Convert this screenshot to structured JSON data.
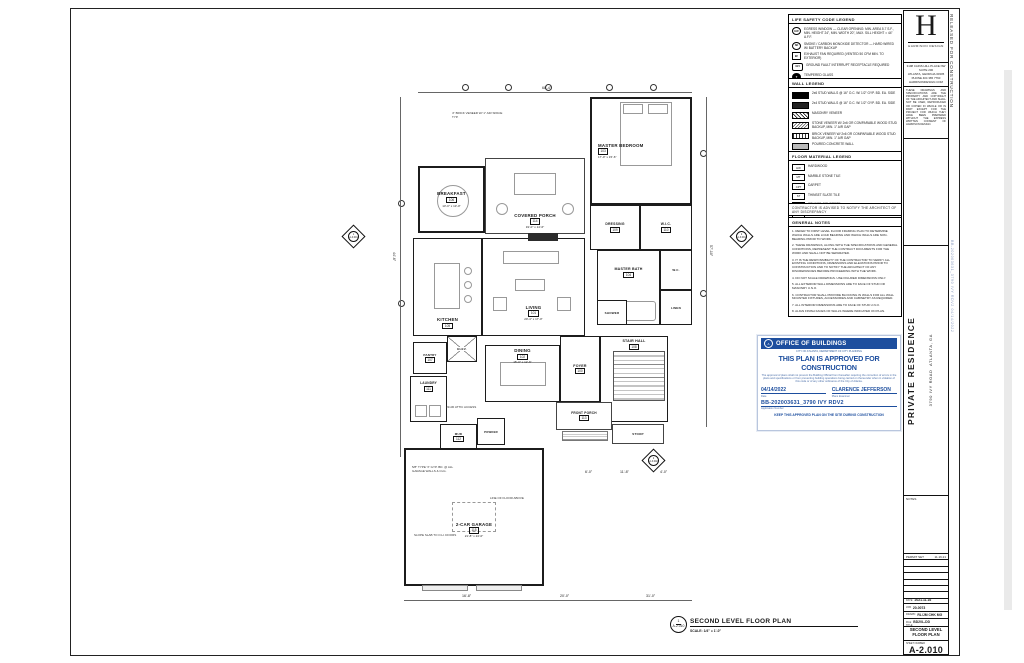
{
  "colors": {
    "paper": "#ffffff",
    "ink": "#1a1a1a",
    "stamp_blue": "#1d4e9e"
  },
  "titleblock": {
    "released": "RELEASED FOR CONSTRUCTION",
    "side_ref": "BB-202003631_3790 IVY RDV2  04/14/2022",
    "logo_letter": "H",
    "logo_name": "HARRISON DESIGN",
    "address_lines": [
      "3198 CAINS HILL PLACE NW",
      "SUITE 200",
      "ATLANTA, GEORGIA 30305",
      "PHONE 404 365 7760",
      "HARRISONDESIGN.COM"
    ],
    "copyright": "THESE DRAWINGS AND SPECIFICATIONS ARE THE PROPERTY AND COPYRIGHT OF THE ARCHITECT AND SHALL NOT BE USED, REPRODUCED OR COPIED IN WHOLE OR IN PART EXCEPT FOR THE PROJECT FOR WHICH THEY HAVE BEEN PREPARED WITHOUT THE EXPRESS WRITTEN CONSENT OF HARRISON DESIGN.",
    "project_name": "PRIVATE RESIDENCE",
    "project_address_1": "3790 IVY ROAD",
    "project_address_2": "ATLANTA, GA",
    "notes_label": "NOTES",
    "revision_left": "PERMIT SET",
    "revision_right": "11.16.21",
    "fields": [
      {
        "label": "DATE",
        "value": "2021.11.16"
      },
      {
        "label": "JOB",
        "value": "20-0073"
      },
      {
        "label": "DRAWN",
        "value": "RL/JM  CHK MG"
      },
      {
        "label": "FILE",
        "value": "BD20L-DD"
      }
    ],
    "title_label": "TITLE",
    "sheet_title": "SECOND LEVEL FLOOR PLAN",
    "sheet_number_label": "SHEET NUMBER",
    "sheet_number": "A-2.010"
  },
  "legends": {
    "life_safety": {
      "title": "LIFE SAFETY CODE LEGEND",
      "items": [
        {
          "icon": "EW",
          "text": "EGRESS WINDOW — CLEAR OPENING: MIN. AREA 5.7 S.F., MIN. HEIGHT 24\", MIN. WIDTH 20\", MAX. SILL HEIGHT = 44\" A.F.F."
        },
        {
          "icon": "SD",
          "text": "SMOKE / CARBON MONOXIDE DETECTOR — HARD WIRED W/ BATTERY BACKUP"
        },
        {
          "icon": "EF",
          "text": "EXHAUST FAN REQUIRED (VENTED 50 CFM MIN. TO EXTERIOR)"
        },
        {
          "icon": "GFI",
          "text": "GROUND FAULT INTERRUPT RECEPTACLE REQUIRED"
        },
        {
          "icon": "T",
          "text": "TEMPERED GLASS"
        }
      ]
    },
    "wall": {
      "title": "WALL LEGEND",
      "items": [
        {
          "swatch": "solid",
          "text": "2x6 STUD WALLS @ 16\" O.C. W/ 1/2\" GYP. BD. EA. SIDE"
        },
        {
          "swatch": "solid2",
          "text": "2x4 STUD WALLS @ 16\" O.C. W/ 1/2\" GYP. BD. EA. SIDE"
        },
        {
          "swatch": "hatch",
          "text": "MASONRY VENEER"
        },
        {
          "swatch": "stone",
          "text": "STONE VENEER W/ 2x6 OR COMPARABLE WOOD STUD BACKUP, MIN. 1\" AIR GAP"
        },
        {
          "swatch": "brick",
          "text": "BRICK VENEER W/ 2x6 OR COMPARABLE WOOD STUD BACKUP, MIN. 1\" AIR GAP"
        },
        {
          "swatch": "conc",
          "text": "POURED CONCRETE WALL"
        },
        {
          "swatch": "cmu",
          "text": "8\" CMU WALL"
        },
        {
          "swatch": "dash",
          "text": "CHIMNEY / FOUNDATION PAD — 12\" THICK MIN. W/ #4 REBAR @ 12\" O.C. EA. WAY"
        }
      ]
    },
    "floor": {
      "title": "FLOOR MATERIAL LEGEND",
      "items": [
        {
          "tag": "HW",
          "label": "HARDWOOD"
        },
        {
          "tag": "MT",
          "label": "MARBLE STONE TILE"
        },
        {
          "tag": "CPT",
          "label": "CARPET"
        },
        {
          "tag": "ST",
          "label": "THINSET SLATE TILE"
        },
        {
          "tag": "SC",
          "label": "STAINED CONCRETE"
        },
        {
          "tag": "BCP",
          "label": "BRICK COBBLESTONE PAVERS"
        }
      ]
    },
    "note_strip": "CONTRACTOR IS ADVISED TO NOTIFY THE ARCHITECT OF ANY DISCREPANCY",
    "general": {
      "title": "GENERAL NOTES",
      "items": [
        "1. REFER TO FIRST LEVEL FLOOR FRAMING PLAN TO DETERMINE WHICH WALLS ARE LOAD BEARING AND WHICH WALLS ARE NON-BEARING PRIOR TO WORK.",
        "2. THESE DRAWINGS, ALONG WITH THE SPECIFICATIONS AND GENERAL CONDITIONS, REPRESENT THE CONTRACT DOCUMENTS FOR THE WORK AND SHALL NOT BE SEPARATED.",
        "3. IT IS THE RESPONSIBILITY OF THE CONTRACTOR TO VERIFY ALL EXISTING CONDITIONS, DIMENSIONS AND ELEVATIONS PRIOR TO CONSTRUCTION AND TO NOTIFY THE ARCHITECT OF ANY DISCREPANCIES BEFORE PROCEEDING WITH THE WORK.",
        "4. DO NOT SCALE DRAWINGS. USE FIGURED DIMENSIONS ONLY.",
        "5. ALL EXTERIOR WALL DIMENSIONS ARE TO FACE OF STUD OR MASONRY U.N.O.",
        "6. CONTRACTOR SHALL PROVIDE BLOCKING IN WALLS FOR ALL WALL MOUNTED FIXTURES, ACCESSORIES AND CABINETRY AS REQUIRED.",
        "7. ALL INTERIOR DIMENSIONS ARE TO FACE OF STUD U.N.O.",
        "8. ALIGN FINISH FACES OF WALLS WHERE INDICATED ON PLAN."
      ]
    }
  },
  "stamp": {
    "org": "OFFICE OF BUILDINGS",
    "seal": "A",
    "sub": "CITY OF ATLANTA, DEPARTMENT OF CITY PLANNING",
    "title": "THIS PLAN IS APPROVED FOR CONSTRUCTION",
    "paragraph": "The approval of plans shall not prevent the Building Official from thereafter requiring the correction of errors in the plans and specifications or from preventing building operations being carried on thereunder when in violation of this code or of any other ordinance of the City of Atlanta.",
    "date_value": "04/14/2022",
    "date_label": "Date",
    "name_value": "CLARENCE JEFFERSON",
    "name_label": "Plans Examiner",
    "permit_value": "BB-202003631_3790 IVY RDV2",
    "permit_label": "Application Number",
    "footer": "KEEP THIS APPROVED PLAN ON THE SITE DURING CONSTRUCTION"
  },
  "plan": {
    "rooms": [
      {
        "name": "MASTER BEDROOM",
        "tag": "103",
        "dims": "17'-0\" x 15'-6\""
      },
      {
        "name": "BREAKFAST",
        "tag": "106",
        "dims": "13'-0\" x 13'-0\""
      },
      {
        "name": "COVERED PORCH",
        "tag": "114",
        "dims": "19'-0\" x 14'-6\""
      },
      {
        "name": "LIVING",
        "tag": "101",
        "dims": "20'-4\" x 17'-0\""
      },
      {
        "name": "KITCHEN",
        "tag": "105",
        "dims": "14'-0\" x 17'-0\""
      },
      {
        "name": "MASTER BATH",
        "tag": "104"
      },
      {
        "name": "DRESSING",
        "tag": "109"
      },
      {
        "name": "W.I.C.",
        "tag": "110"
      },
      {
        "name": "DINING",
        "tag": "102",
        "dims": "15'-0\" x 12'-6\""
      },
      {
        "name": "FOYER",
        "tag": "100"
      },
      {
        "name": "STAIR HALL",
        "tag": "108"
      },
      {
        "name": "FRONT PORCH",
        "tag": "113"
      },
      {
        "name": "PANTRY",
        "tag": "107"
      },
      {
        "name": "LAUNDRY",
        "tag": "111"
      },
      {
        "name": "MUD",
        "tag": "112"
      },
      {
        "name": "POWDER"
      },
      {
        "name": "2-CAR GARAGE",
        "tag": "115",
        "dims": "21'-8\" x 24'-0\""
      },
      {
        "name": "SHOWER"
      },
      {
        "name": "W.C."
      },
      {
        "name": "ELEV."
      },
      {
        "name": "STOOP"
      },
      {
        "name": "LINEN"
      }
    ],
    "dims": [
      "68'-4\"",
      "44'-6\"",
      "57'-10\"",
      "16'-8\"",
      "20'-0\"",
      "31'-0\"",
      "6'-0\"",
      "11'-8\"",
      "4'-0\""
    ],
    "annotations": [
      "4\" BRICK VENEER W/ 1\" AIR SPACE TYP.",
      "5/8\" TYPE 'X' GYP. BD. @ ALL GARAGE WALLS & CLG.",
      "LINE OF FLOOR ABOVE",
      "SLOPE SLAB TO O.H. DOORS",
      "22x30 ATTIC ACCESS"
    ],
    "markers": [
      {
        "num": "1",
        "sheet": "A-3.001"
      },
      {
        "num": "2",
        "sheet": "A-3.001"
      },
      {
        "num": "2",
        "sheet": "A-3.002"
      }
    ],
    "title_bubble_num": "1",
    "title_bubble_sheet": "A-2.010",
    "title": "SECOND LEVEL FLOOR PLAN",
    "scale": "SCALE: 1/4\" = 1'-0\""
  }
}
